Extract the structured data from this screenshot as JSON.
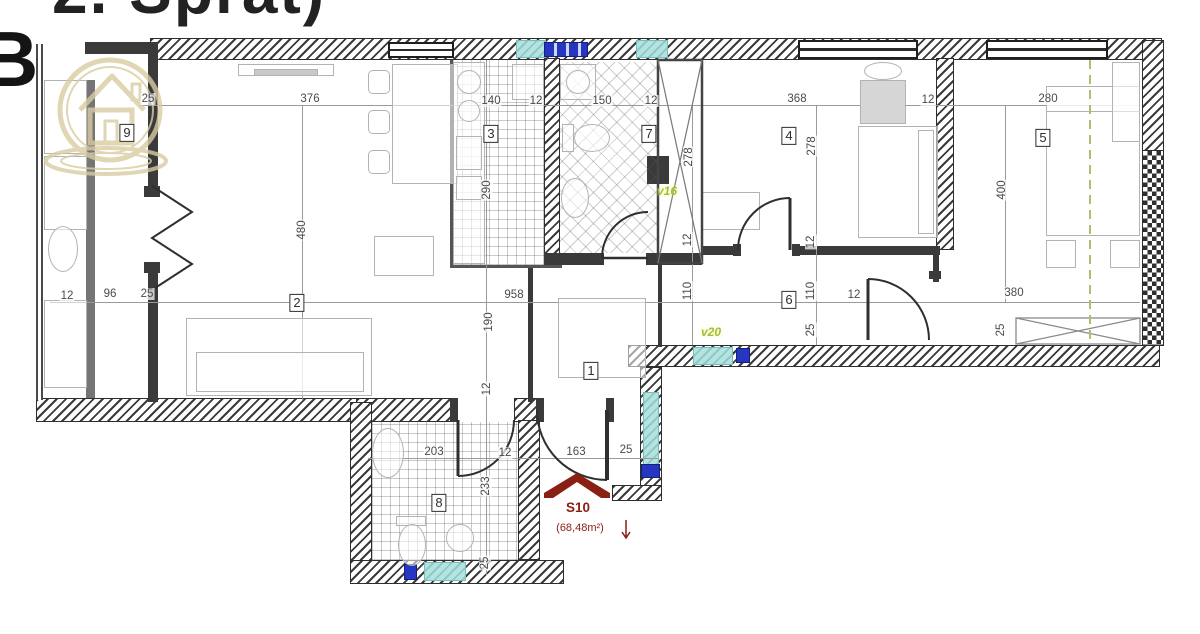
{
  "header": {
    "title_fragment": "2. Sprat)",
    "unit_letter": "B"
  },
  "unit": {
    "id": "S10",
    "area": "(68,48m²)"
  },
  "watermark": {
    "name": "house-logo-watermark",
    "color": "#d9cca2"
  },
  "colors": {
    "glass_teal": "#a4e1dd",
    "vent_blue": "#2636c0",
    "note_green": "#a6bf2f",
    "unit_red": "#8a1f14",
    "wall_dark": "#3a3a3a"
  },
  "rooms": [
    {
      "num": "1",
      "x": 591,
      "y": 371
    },
    {
      "num": "2",
      "x": 297,
      "y": 303
    },
    {
      "num": "3",
      "x": 491,
      "y": 134
    },
    {
      "num": "4",
      "x": 789,
      "y": 136
    },
    {
      "num": "5",
      "x": 1043,
      "y": 138
    },
    {
      "num": "6",
      "x": 789,
      "y": 300
    },
    {
      "num": "7",
      "x": 649,
      "y": 134
    },
    {
      "num": "8",
      "x": 439,
      "y": 503
    },
    {
      "num": "9",
      "x": 127,
      "y": 133
    }
  ],
  "dimensions": [
    {
      "t": "25",
      "x": 148,
      "y": 99,
      "r": 0
    },
    {
      "t": "376",
      "x": 310,
      "y": 99,
      "r": 0
    },
    {
      "t": "140",
      "x": 491,
      "y": 101,
      "r": 0
    },
    {
      "t": "12",
      "x": 536,
      "y": 101,
      "r": 0
    },
    {
      "t": "150",
      "x": 602,
      "y": 101,
      "r": 0
    },
    {
      "t": "12",
      "x": 651,
      "y": 101,
      "r": 0
    },
    {
      "t": "368",
      "x": 797,
      "y": 99,
      "r": 0
    },
    {
      "t": "12",
      "x": 928,
      "y": 100,
      "r": 0
    },
    {
      "t": "280",
      "x": 1048,
      "y": 99,
      "r": 0
    },
    {
      "t": "480",
      "x": 302,
      "y": 230,
      "r": 90
    },
    {
      "t": "290",
      "x": 487,
      "y": 190,
      "r": 90
    },
    {
      "t": "278",
      "x": 689,
      "y": 157,
      "r": 90
    },
    {
      "t": "278",
      "x": 812,
      "y": 146,
      "r": 90
    },
    {
      "t": "400",
      "x": 1002,
      "y": 190,
      "r": 90
    },
    {
      "t": "12",
      "x": 688,
      "y": 240,
      "r": 90
    },
    {
      "t": "110",
      "x": 688,
      "y": 291,
      "r": 90
    },
    {
      "t": "12",
      "x": 811,
      "y": 242,
      "r": 90
    },
    {
      "t": "110",
      "x": 811,
      "y": 291,
      "r": 90
    },
    {
      "t": "25",
      "x": 811,
      "y": 330,
      "r": 90
    },
    {
      "t": "25",
      "x": 1001,
      "y": 330,
      "r": 90
    },
    {
      "t": "12",
      "x": 67,
      "y": 296,
      "r": 0
    },
    {
      "t": "96",
      "x": 110,
      "y": 294,
      "r": 0
    },
    {
      "t": "25",
      "x": 147,
      "y": 294,
      "r": 0
    },
    {
      "t": "958",
      "x": 514,
      "y": 295,
      "r": 0
    },
    {
      "t": "380",
      "x": 1014,
      "y": 293,
      "r": 0
    },
    {
      "t": "12",
      "x": 854,
      "y": 295,
      "r": 0
    },
    {
      "t": "190",
      "x": 489,
      "y": 322,
      "r": 90
    },
    {
      "t": "12",
      "x": 487,
      "y": 389,
      "r": 90
    },
    {
      "t": "203",
      "x": 434,
      "y": 452,
      "r": 0
    },
    {
      "t": "12",
      "x": 505,
      "y": 453,
      "r": 0
    },
    {
      "t": "163",
      "x": 576,
      "y": 452,
      "r": 0
    },
    {
      "t": "25",
      "x": 626,
      "y": 450,
      "r": 0
    },
    {
      "t": "233",
      "x": 486,
      "y": 486,
      "r": 90
    },
    {
      "t": "25",
      "x": 485,
      "y": 563,
      "r": 90
    }
  ],
  "notes": [
    {
      "t": "v16",
      "x": 667,
      "y": 191
    },
    {
      "t": "v20",
      "x": 711,
      "y": 332
    }
  ]
}
